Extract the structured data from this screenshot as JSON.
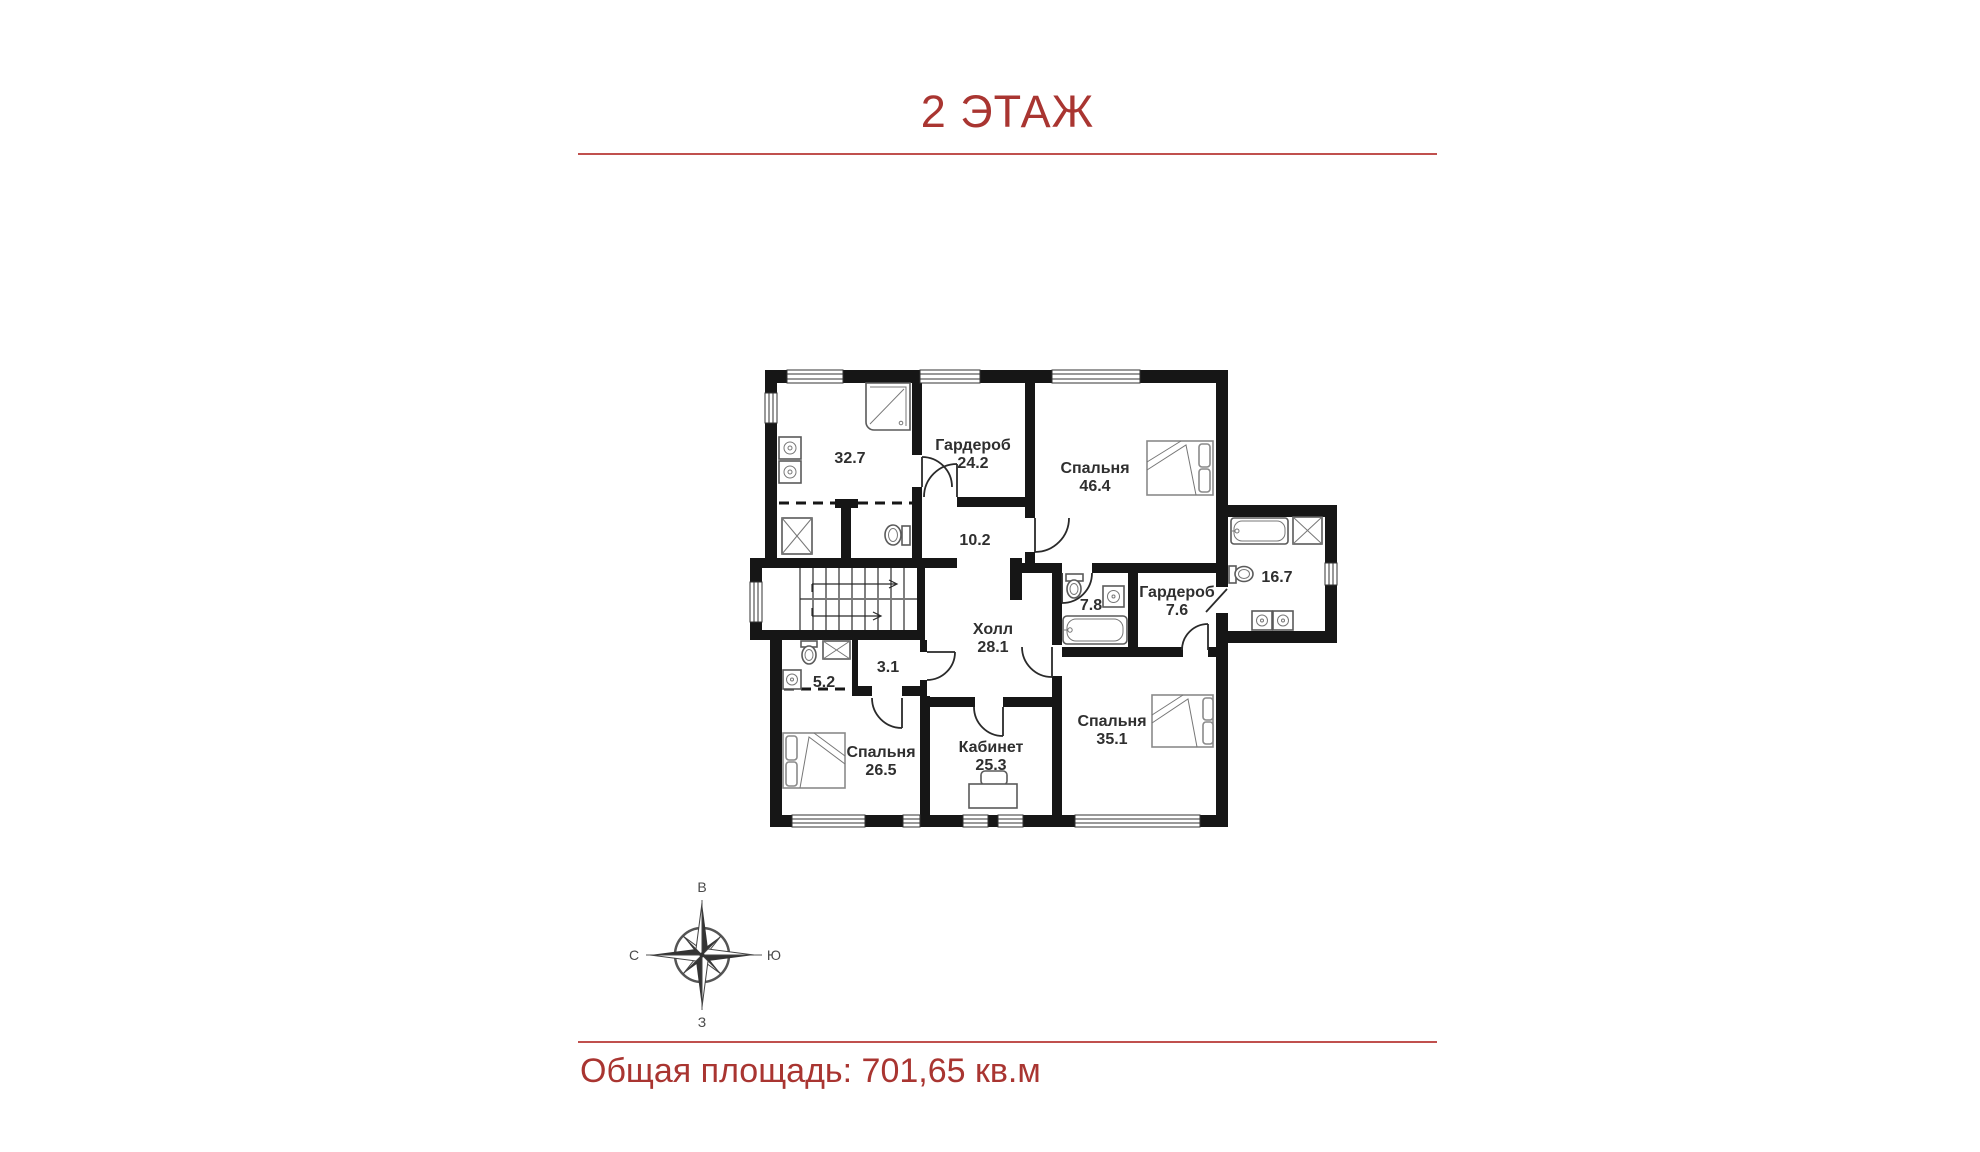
{
  "header": {
    "title": "2 ЭТАЖ"
  },
  "footer": {
    "label": "Общая площадь:",
    "value": "701,65 кв.м"
  },
  "colors": {
    "accent_line": "#c0504d",
    "heading_text": "#a93531",
    "wall": "#161616"
  },
  "compass": {
    "top": "В",
    "right": "Ю",
    "left": "С",
    "bottom": "З"
  },
  "rooms": [
    {
      "id": "bathroom-32-7",
      "name": "",
      "area": "32.7"
    },
    {
      "id": "wardrobe-24-2",
      "name": "Гардероб",
      "area": "24.2"
    },
    {
      "id": "bedroom-46-4",
      "name": "Спальня",
      "area": "46.4"
    },
    {
      "id": "corridor-10-2",
      "name": "",
      "area": "10.2"
    },
    {
      "id": "hall-28-1",
      "name": "Холл",
      "area": "28.1"
    },
    {
      "id": "bathroom-7-8",
      "name": "",
      "area": "7.8"
    },
    {
      "id": "wardrobe-7-6",
      "name": "Гардероб",
      "area": "7.6"
    },
    {
      "id": "bathroom-16-7",
      "name": "",
      "area": "16.7"
    },
    {
      "id": "bathroom-5-2",
      "name": "",
      "area": "5.2"
    },
    {
      "id": "storage-3-1",
      "name": "",
      "area": "3.1"
    },
    {
      "id": "bedroom-26-5",
      "name": "Спальня",
      "area": "26.5"
    },
    {
      "id": "office-25-3",
      "name": "Кабинет",
      "area": "25.3"
    },
    {
      "id": "bedroom-35-1",
      "name": "Спальня",
      "area": "35.1"
    }
  ]
}
